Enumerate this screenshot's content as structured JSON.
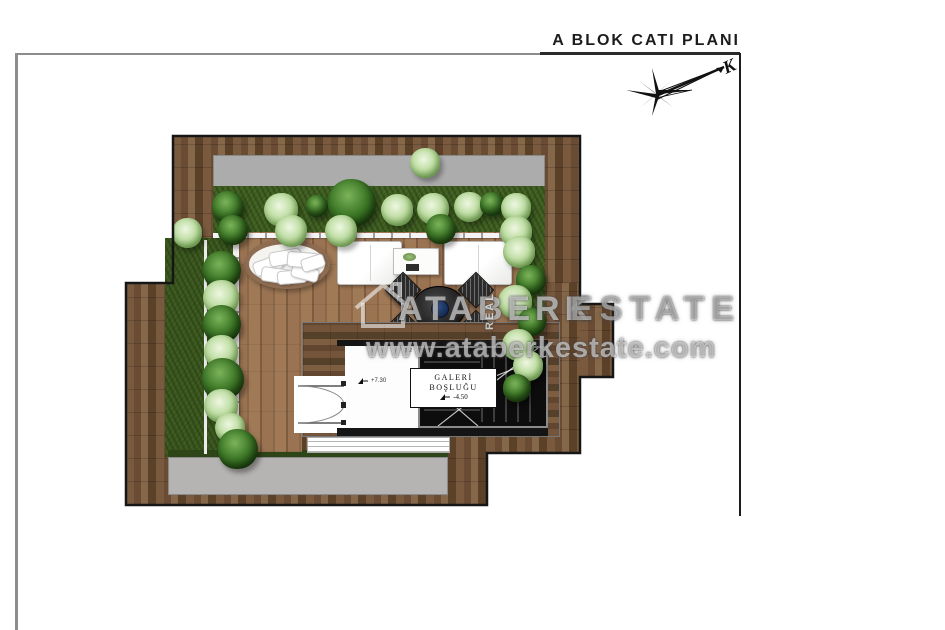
{
  "title": "A BLOK CATI PLANI",
  "compass": {
    "north_label": "K"
  },
  "watermark": {
    "brand": "ATABERK",
    "middle": "REAL",
    "suffix": "ESTATE",
    "url": "www.ataberkestate.com"
  },
  "plan": {
    "gallery": {
      "line1": "GALERİ",
      "line2": "BOŞLUĞU",
      "level": "-4.50"
    },
    "room": {
      "level": "+7.30",
      "scale_note": "1:2"
    }
  },
  "colors": {
    "wood_border": "#6b4c34",
    "wood_deck": "#94704e",
    "grass": "#3f5e20",
    "concrete_gray": "#acacac",
    "stair_marble": "#0d0d0d",
    "bush_dark": "#2f6020",
    "bush_light": "#c2dfa8",
    "outline": "#161616"
  },
  "bushes": [
    {
      "x": 425,
      "y": 163,
      "r": 15,
      "type": "light"
    },
    {
      "x": 228,
      "y": 207,
      "r": 16,
      "type": "dark"
    },
    {
      "x": 281,
      "y": 210,
      "r": 17,
      "type": "light"
    },
    {
      "x": 317,
      "y": 206,
      "r": 11,
      "type": "dark"
    },
    {
      "x": 352,
      "y": 203,
      "r": 24,
      "type": "dark"
    },
    {
      "x": 397,
      "y": 210,
      "r": 16,
      "type": "light"
    },
    {
      "x": 433,
      "y": 209,
      "r": 16,
      "type": "light"
    },
    {
      "x": 469,
      "y": 207,
      "r": 15,
      "type": "light"
    },
    {
      "x": 492,
      "y": 204,
      "r": 12,
      "type": "dark"
    },
    {
      "x": 516,
      "y": 208,
      "r": 15,
      "type": "light"
    },
    {
      "x": 187,
      "y": 233,
      "r": 15,
      "type": "light"
    },
    {
      "x": 233,
      "y": 230,
      "r": 15,
      "type": "dark"
    },
    {
      "x": 291,
      "y": 231,
      "r": 16,
      "type": "light"
    },
    {
      "x": 341,
      "y": 231,
      "r": 16,
      "type": "light"
    },
    {
      "x": 441,
      "y": 229,
      "r": 15,
      "type": "dark"
    },
    {
      "x": 516,
      "y": 232,
      "r": 16,
      "type": "light"
    },
    {
      "x": 222,
      "y": 270,
      "r": 19,
      "type": "dark"
    },
    {
      "x": 221,
      "y": 298,
      "r": 18,
      "type": "light"
    },
    {
      "x": 222,
      "y": 324,
      "r": 19,
      "type": "dark"
    },
    {
      "x": 221,
      "y": 352,
      "r": 17,
      "type": "light"
    },
    {
      "x": 223,
      "y": 379,
      "r": 21,
      "type": "dark"
    },
    {
      "x": 221,
      "y": 406,
      "r": 17,
      "type": "light"
    },
    {
      "x": 230,
      "y": 428,
      "r": 15,
      "type": "light"
    },
    {
      "x": 238,
      "y": 449,
      "r": 20,
      "type": "dark"
    },
    {
      "x": 519,
      "y": 252,
      "r": 16,
      "type": "light"
    },
    {
      "x": 531,
      "y": 280,
      "r": 15,
      "type": "dark"
    },
    {
      "x": 515,
      "y": 302,
      "r": 17,
      "type": "light"
    },
    {
      "x": 532,
      "y": 322,
      "r": 14,
      "type": "dark"
    },
    {
      "x": 518,
      "y": 345,
      "r": 16,
      "type": "light"
    },
    {
      "x": 528,
      "y": 366,
      "r": 15,
      "type": "light"
    },
    {
      "x": 517,
      "y": 388,
      "r": 14,
      "type": "dark"
    }
  ]
}
